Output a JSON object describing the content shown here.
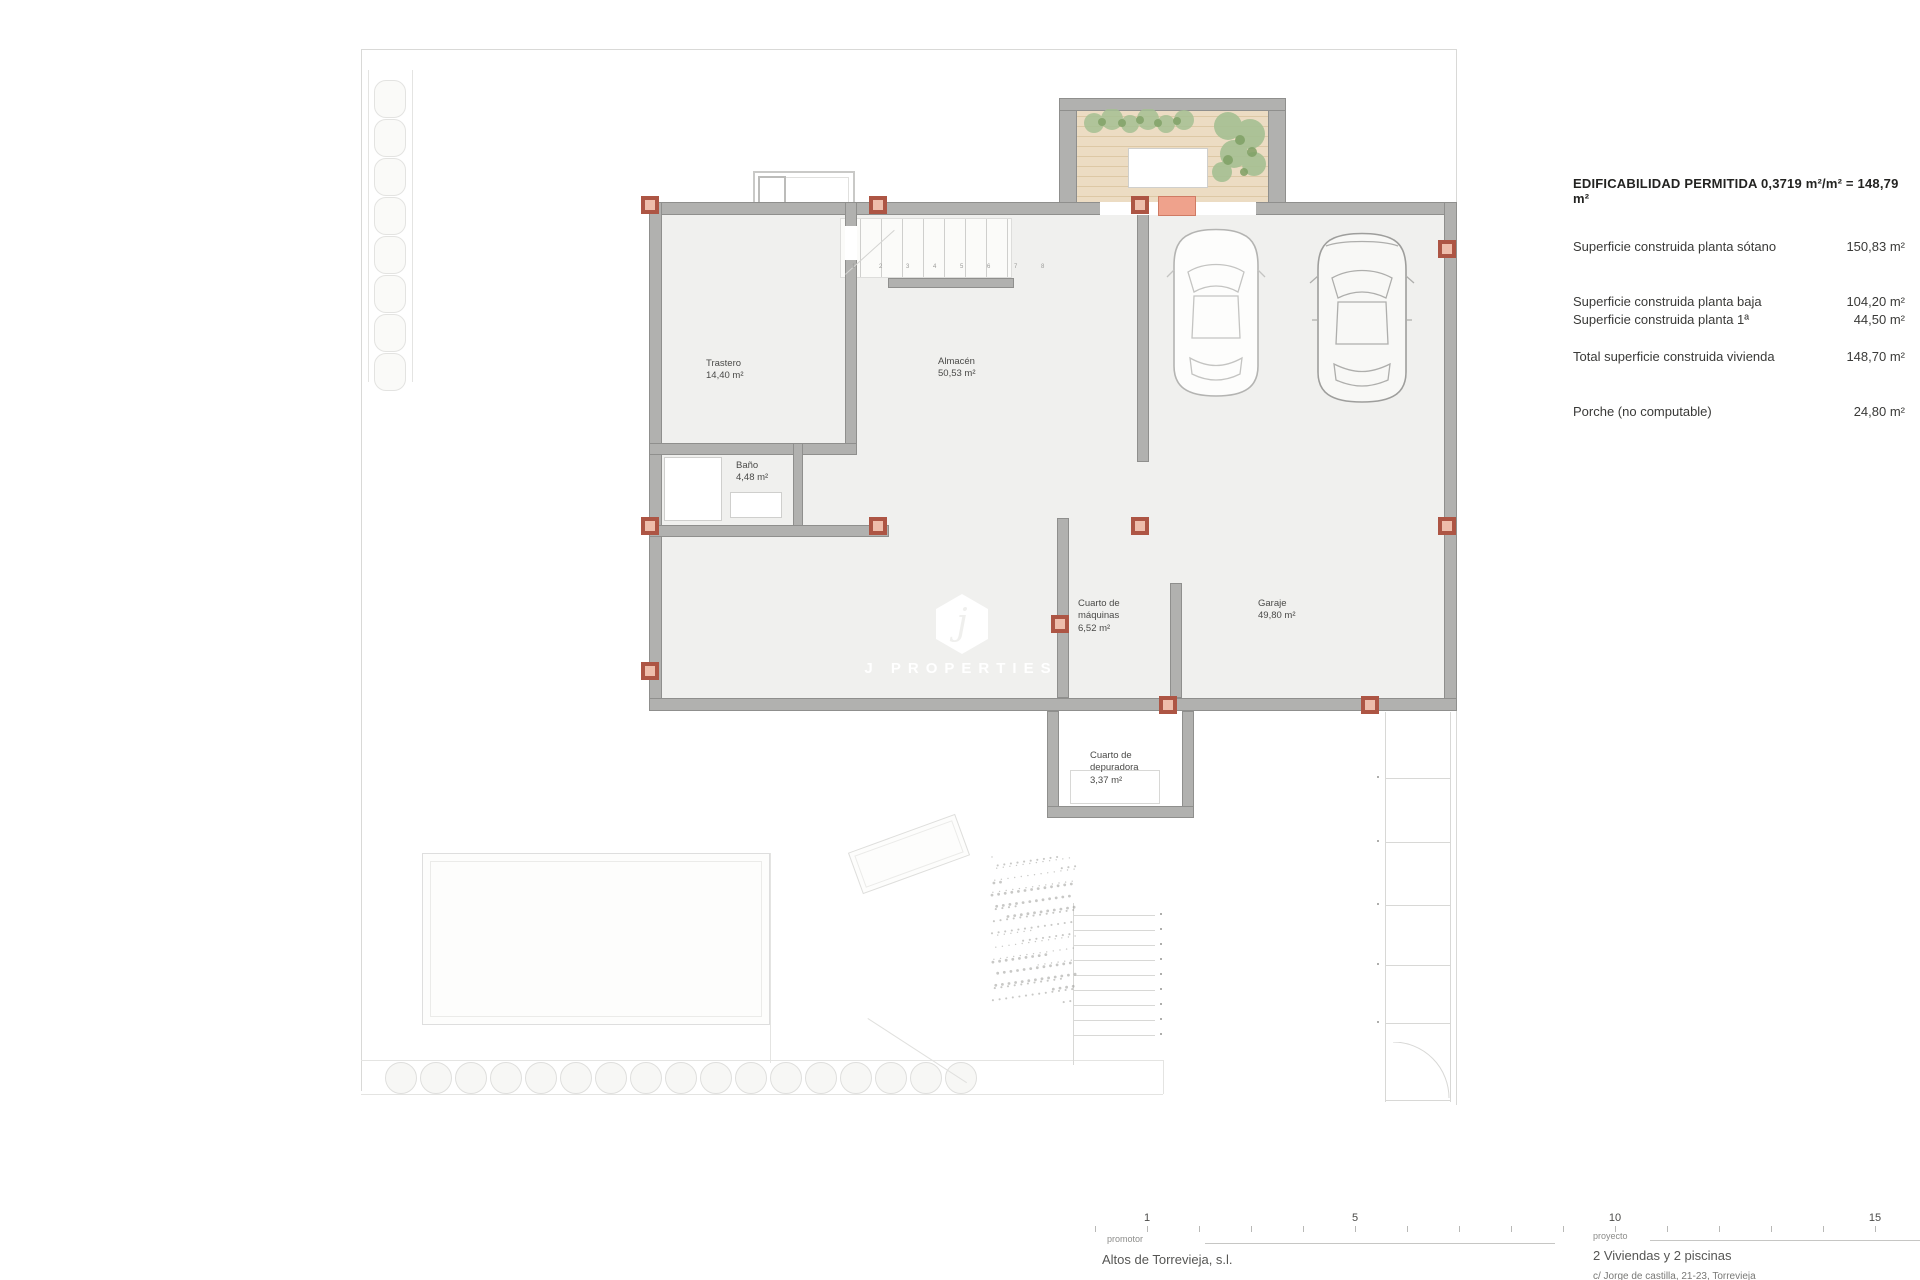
{
  "drawing": {
    "rooms": {
      "trastero": {
        "name": "Trastero",
        "area": "14,40 m²"
      },
      "almacen": {
        "name": "Almacén",
        "area": "50,53 m²"
      },
      "bano": {
        "name": "Baño",
        "area": "4,48 m²"
      },
      "maquinas": {
        "line1": "Cuarto de",
        "line2": "máquinas",
        "area": "6,52 m²"
      },
      "garaje": {
        "name": "Garaje",
        "area": "49,80 m²"
      },
      "depuradora": {
        "line1": "Cuarto de",
        "line2": "depuradora",
        "area": "3,37 m²"
      }
    },
    "stair_numbers": "1 2 3 4 5 6 7 8",
    "watermark": {
      "letter": "j",
      "brand": "J PROPERTIES"
    }
  },
  "info_panel": {
    "title": "EDIFICABILIDAD PERMITIDA 0,3719 m²/m² = 148,79 m²",
    "rows": [
      {
        "label": "Superficie construida planta sótano",
        "value": "150,83 m²"
      },
      {
        "label": "Superficie construida planta baja",
        "value": "104,20 m²"
      },
      {
        "label": "Superficie construida planta 1ª",
        "value": "44,50 m²"
      },
      {
        "label": "Total superficie construida vivienda",
        "value": "148,70 m²"
      },
      {
        "label": "Porche (no computable)",
        "value": "24,80 m²"
      }
    ]
  },
  "scale_bar": {
    "labels": [
      "1",
      "5",
      "10",
      "15"
    ],
    "units": [
      1,
      5,
      10,
      15
    ]
  },
  "title_block": {
    "promotor_label": "promotor",
    "promotor_name": "Altos de Torrevieja, s.l.",
    "proyecto_label": "proyecto",
    "proyecto_name": "2 Viviendas y 2 piscinas",
    "proyecto_address": "c/ Jorge de castilla, 21-23, Torrevieja"
  },
  "colors": {
    "wall": "#b1b1af",
    "column_border": "#ad5544",
    "column_fill": "#eebdab",
    "deck": "#ecdcc3",
    "plant": "#9cb989",
    "floor": "#f0f0ee"
  }
}
